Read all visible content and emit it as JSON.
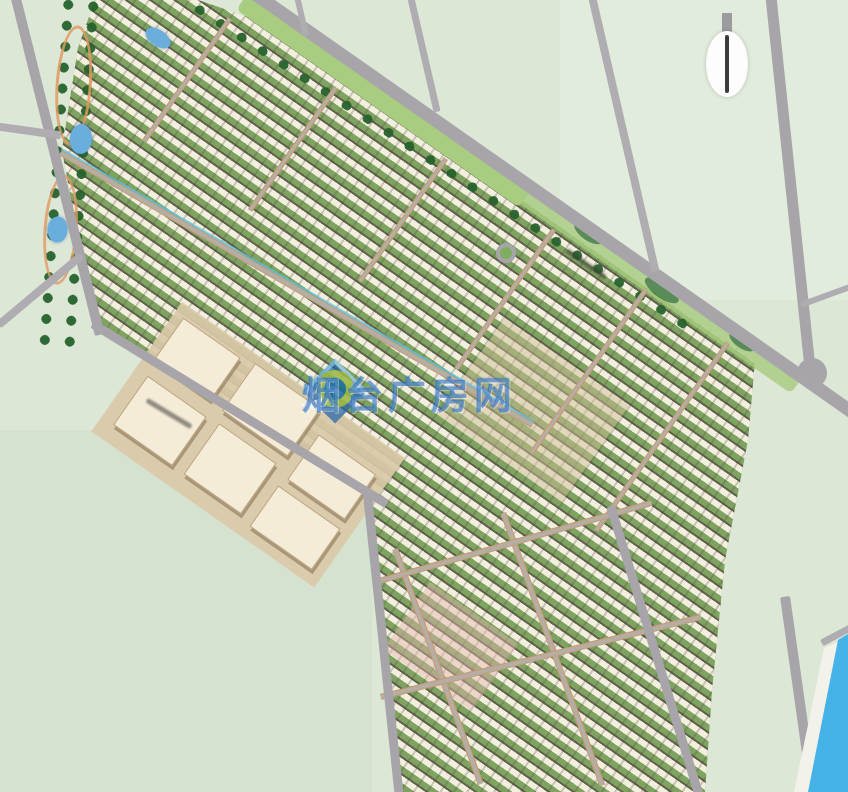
{
  "watermark": {
    "text": "烟台广房网",
    "color": "#1762bc"
  },
  "compass": {
    "icon": "north-arrow"
  },
  "palette": {
    "field": "#dce7d6",
    "road": "#a8a5aa",
    "verge_green": "#a8cc80",
    "tree_green": "#2e6a31",
    "estate_green": "#7ba05f",
    "roof": "#f2efdf",
    "roof_shadow": "#60604b",
    "public_building": "#f5ecd8",
    "sand_base": "#d9c9a8",
    "river_water": "#45b2e8",
    "pond_water": "#6aaede",
    "watermark_blue": "#1762bc"
  }
}
